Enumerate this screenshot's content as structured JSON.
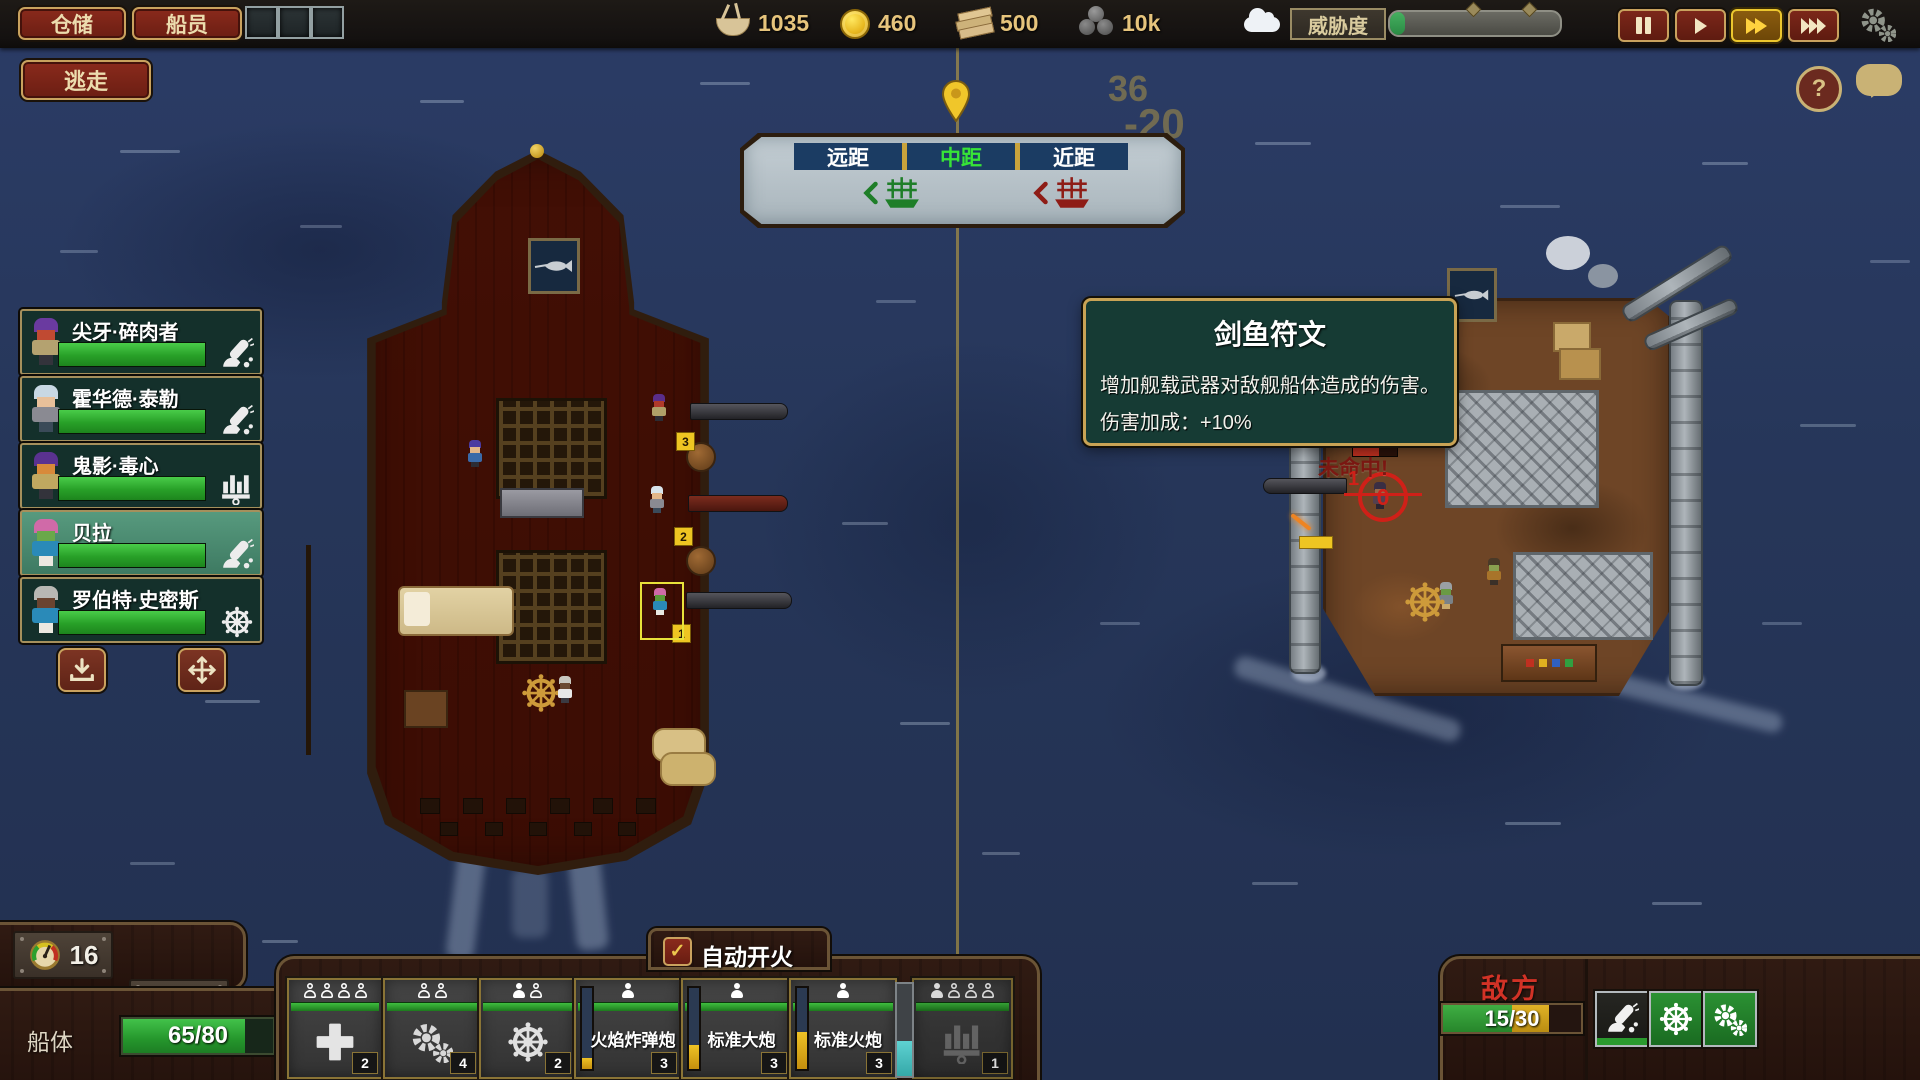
{
  "top_bar": {
    "warehouse_button": "仓储",
    "crew_button": "船员",
    "resources": [
      {
        "icon": "food-bowl-icon",
        "value": "1035"
      },
      {
        "icon": "coin-icon",
        "value": "460"
      },
      {
        "icon": "wood-icon",
        "value": "500"
      },
      {
        "icon": "cannonball-icon",
        "value": "10k"
      }
    ],
    "threat": {
      "label": "威胁度",
      "percent": 9
    }
  },
  "escape_button": "逃走",
  "help_button": "?",
  "distance_tabs": {
    "far": "远距",
    "mid": "中距",
    "near": "近距",
    "selected": "mid"
  },
  "floating_numbers": {
    "n1": "36",
    "n2": "-20"
  },
  "crew_list": [
    {
      "name": "尖牙·碎肉者",
      "hp": 100,
      "role": "cannon"
    },
    {
      "name": "霍华德·泰勒",
      "hp": 100,
      "role": "cannon"
    },
    {
      "name": "鬼影·毒心",
      "hp": 100,
      "role": "organ-gun"
    },
    {
      "name": "贝拉",
      "hp": 100,
      "role": "cannon",
      "selected": true
    },
    {
      "name": "罗伯特·史密斯",
      "hp": 100,
      "role": "helm"
    }
  ],
  "tooltip": {
    "title": "剑鱼符文",
    "description": "增加舰载武器对敌舰船体造成的伤害。",
    "bonus": "伤害加成：+10%"
  },
  "battle": {
    "miss_text": "未命中!",
    "target_number": "0",
    "queue_number": "1",
    "cannon_tags": [
      "3",
      "2",
      "1"
    ]
  },
  "player_hud": {
    "speed": "16",
    "helm_crew": "22",
    "hull_label": "船体",
    "hull_text": "65/80",
    "hull_percent": 81
  },
  "auto_fire": {
    "label": "自动开火",
    "checked": true
  },
  "weapon_slots": [
    {
      "type": "repair-station",
      "badge": "2",
      "crew_filled": 0,
      "crew_total": 4
    },
    {
      "type": "engine-station",
      "badge": "4",
      "crew_filled": 0,
      "crew_total": 2
    },
    {
      "type": "helm-station",
      "badge": "2",
      "crew_filled": 1,
      "crew_total": 2
    },
    {
      "type": "cannon",
      "label": "火焰炸弹炮",
      "badge": "3",
      "crew_filled": 1,
      "crew_total": 1,
      "charge": 14
    },
    {
      "type": "cannon",
      "label": "标准大炮",
      "badge": "3",
      "crew_filled": 1,
      "crew_total": 1,
      "charge": 30
    },
    {
      "type": "cannon",
      "label": "标准火炮",
      "badge": "3",
      "crew_filled": 1,
      "crew_total": 1,
      "charge": 46
    },
    {
      "type": "organ-gun",
      "badge": "1",
      "crew_filled": 1,
      "crew_total": 4,
      "disabled": true
    }
  ],
  "ammo_gauge_percent": 38,
  "enemy_panel": {
    "label": "敌方",
    "hp_text": "15/30",
    "hp_green": 50,
    "hp_yellow": 27
  }
}
